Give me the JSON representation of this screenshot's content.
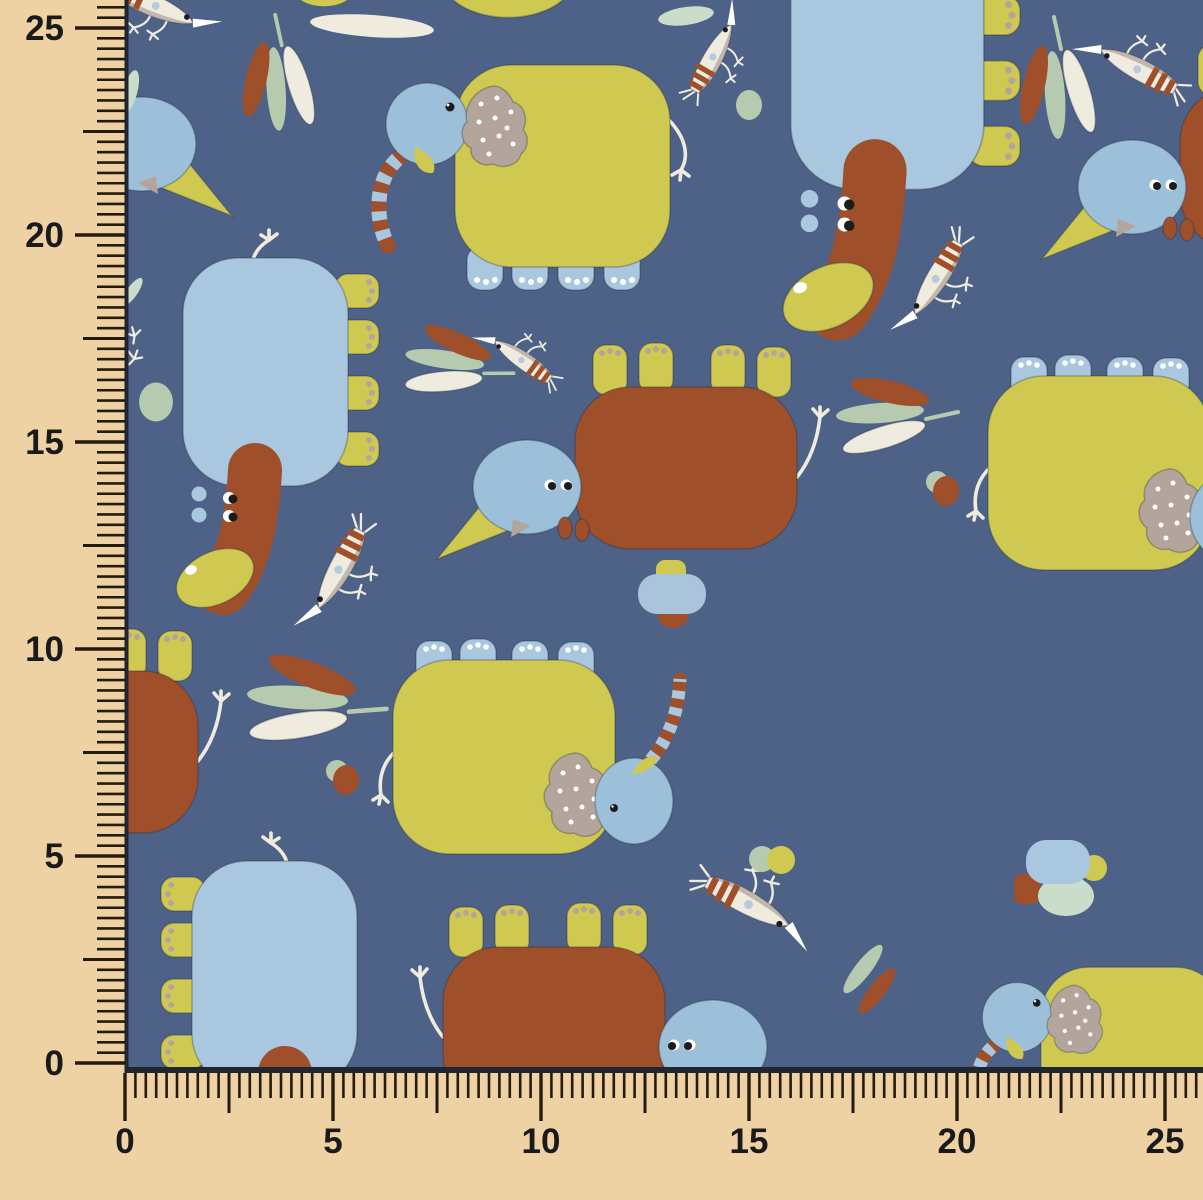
{
  "meta": {
    "description": "fabric swatch product photo: blue children's fabric with elephants, shrimp-birds, leaves and pebbles, framed by cm rulers on left and bottom edges",
    "width_px": 1203,
    "height_px": 1200
  },
  "colors": {
    "ruler_bg": "#eed2a4",
    "tick": "#241b0c",
    "label": "#1a1a1a",
    "fabric_edge": "#1f2531",
    "fabric_blue": "#4d6286",
    "yellow": "#cfc952",
    "light_blue": "#a9c7df",
    "head_blue": "#9cc0da",
    "pale_blue": "#aac4da",
    "rust": "#9f502b",
    "taupe": "#b3a49c",
    "sage": "#b6cab0",
    "pale_sage": "#cadcca",
    "cream": "#f0ebdf",
    "white": "#ffffff",
    "eye": "#1c1c1c"
  },
  "rulers": {
    "vertical": {
      "labels": [
        "25",
        "20",
        "15",
        "10",
        "5",
        "0"
      ],
      "values": [
        25,
        20,
        15,
        10,
        5,
        0
      ],
      "px_per_unit": 41.4,
      "zero_y": 1063,
      "edge_x": 125,
      "max_value": 25.55,
      "tick_step": 0.25,
      "label_right_x": 64
    },
    "horizontal": {
      "labels": [
        "0",
        "5",
        "10",
        "15",
        "20",
        "25"
      ],
      "values": [
        0,
        5,
        10,
        15,
        20,
        25
      ],
      "px_per_unit": 41.6,
      "zero_x": 125,
      "edge_y": 1073,
      "max_value": 25.85,
      "tick_step": 0.25,
      "label_baseline_y": 1153
    }
  },
  "pattern": {
    "motifs": [
      {
        "type": "elephant-a",
        "name": "elephant-yellow-blue-head",
        "x": 355,
        "y": 60
      },
      {
        "type": "elephant-a",
        "name": "elephant-yellow-blue-head",
        "x": 956,
        "y": 963,
        "s": 0.85
      },
      {
        "type": "elephant-b",
        "name": "elephant-blue-trunk-down",
        "x": 758,
        "y": -89,
        "s": 1.17
      },
      {
        "type": "elephant-b",
        "name": "elephant-blue-trunk-down",
        "x": 155,
        "y": 248
      },
      {
        "type": "elephant-b",
        "name": "elephant-blue-trunk-down",
        "x": 385,
        "y": 851,
        "flipx": true
      },
      {
        "type": "elephant-c",
        "name": "elephant-brown-blue-head",
        "x": 425,
        "y": 325
      },
      {
        "type": "elephant-c",
        "name": "elephant-brown-blue-head",
        "x": 815,
        "y": 885,
        "flipx": true
      },
      {
        "type": "elephant-c",
        "name": "elephant-brown-blue-head",
        "x": 1030,
        "y": 25
      },
      {
        "type": "elephant-c",
        "name": "elephant-brown-partial-edge",
        "x": -174,
        "y": 609
      },
      {
        "type": "elephant-c",
        "name": "elephant-head-at-left-edge",
        "x": 244,
        "y": -18,
        "flipx": true
      },
      {
        "type": "elephant-d",
        "name": "elephant-yellow-upside-down",
        "x": 378,
        "y": 645
      },
      {
        "type": "elephant-d",
        "name": "elephant-yellow-upside-down",
        "x": 973,
        "y": 361
      },
      {
        "type": "shrimp",
        "name": "shrimp-bird",
        "x": 158,
        "y": 8,
        "r": 25
      },
      {
        "type": "shrimp",
        "name": "shrimp-bird",
        "x": 715,
        "y": 55,
        "r": -60,
        "s": 0.9
      },
      {
        "type": "shrimp",
        "name": "shrimp-bird",
        "x": 1135,
        "y": 67,
        "r": -151
      },
      {
        "type": "shrimp",
        "name": "shrimp-bird",
        "x": 935,
        "y": 282,
        "r": 120,
        "flipy": true
      },
      {
        "type": "shrimp",
        "name": "shrimp-bird",
        "x": 520,
        "y": 358,
        "r": -144,
        "s": 0.8
      },
      {
        "type": "shrimp",
        "name": "shrimp-bird",
        "x": 338,
        "y": 573,
        "r": 117,
        "s": 1.05,
        "flipy": true
      },
      {
        "type": "shrimp",
        "name": "shrimp-bird",
        "x": 752,
        "y": 905,
        "r": 27,
        "s": 1.1,
        "flipy": true
      },
      {
        "type": "leaf-cluster",
        "name": "leaf-cluster",
        "x": 278,
        "y": 70,
        "r": -90,
        "s": 0.95
      },
      {
        "type": "leaf-cluster",
        "name": "leaf-cluster",
        "x": 462,
        "y": 365,
        "r": 12,
        "s": 0.9
      },
      {
        "type": "leaf-cluster",
        "name": "leaf-cluster",
        "x": 900,
        "y": 415
      },
      {
        "type": "leaf-cluster",
        "name": "leaf-cluster",
        "x": 1057,
        "y": 75,
        "r": -90
      },
      {
        "type": "leaf-cluster",
        "name": "leaf-cluster",
        "x": 320,
        "y": 703,
        "r": 8,
        "s": 1.15
      },
      {
        "type": "leaf-duo",
        "name": "leaf-pair",
        "x": 870,
        "y": 980
      },
      {
        "type": "edge-leaf",
        "name": "leaf-at-edge",
        "x": 686,
        "y": 16,
        "r": -8
      },
      {
        "type": "edge-leaf",
        "name": "leaf-at-edge",
        "x": 130,
        "y": 92,
        "r": -75,
        "s": 0.8
      },
      {
        "type": "edge-leaf",
        "name": "leaf-at-edge",
        "x": 132,
        "y": 292,
        "r": -55,
        "s": 0.6
      },
      {
        "type": "edge-leaf-cream",
        "name": "leaf-white",
        "x": 372,
        "y": 26,
        "r": 4
      },
      {
        "type": "pebble-sage",
        "name": "pebble",
        "x": 749,
        "y": 105
      },
      {
        "type": "pebble-sage",
        "name": "pebble",
        "x": 156,
        "y": 402,
        "s": 1.3
      },
      {
        "type": "pebble-duo",
        "name": "pebble",
        "x": 944,
        "y": 489
      },
      {
        "type": "pebble-duo",
        "name": "pebble",
        "x": 344,
        "y": 778
      },
      {
        "type": "pebble-sage-yellow",
        "name": "pebble",
        "x": 773,
        "y": 859
      },
      {
        "type": "pebble-trio",
        "name": "pebble-stack",
        "x": 672,
        "y": 592
      },
      {
        "type": "pebble-quad",
        "name": "pebble-stack",
        "x": 1060,
        "y": 882
      },
      {
        "type": "sparkle",
        "name": "sparkle",
        "x": 134,
        "y": 334,
        "r": -15
      },
      {
        "type": "sparkle",
        "name": "sparkle",
        "x": 135,
        "y": 357,
        "r": 20
      },
      {
        "type": "edge-arc",
        "name": "partial-motif-at-top-edge",
        "x": 324,
        "y": -12,
        "s": 0.62
      },
      {
        "type": "edge-arc",
        "name": "partial-motif-at-top-edge",
        "x": 508,
        "y": -22,
        "s": 1.32
      }
    ]
  }
}
